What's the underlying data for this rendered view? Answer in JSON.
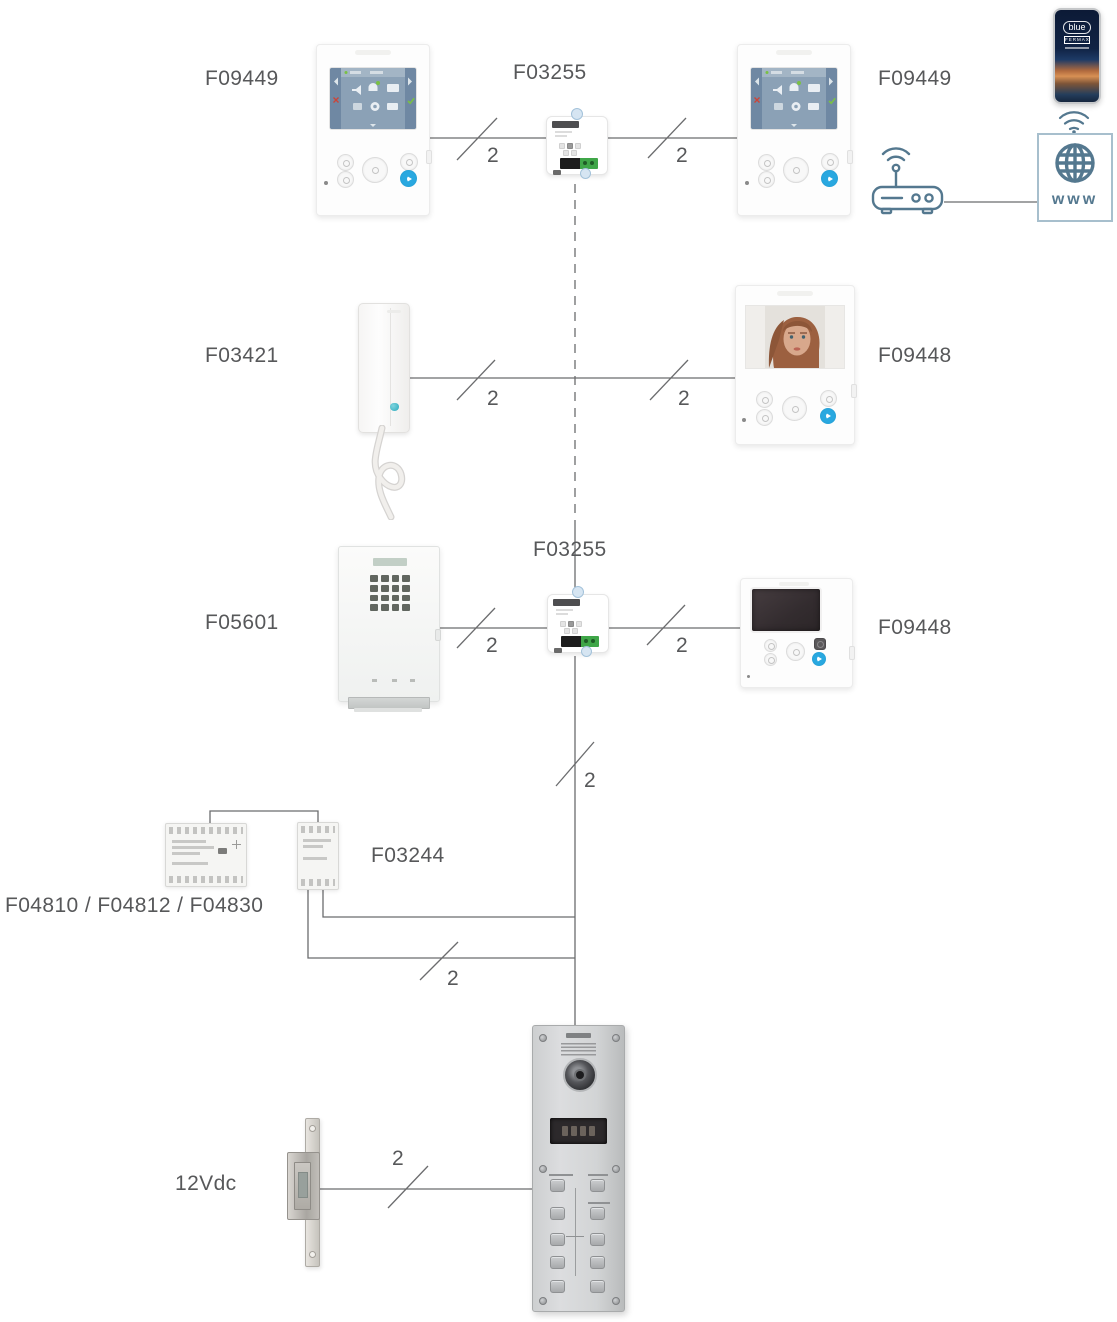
{
  "diagram": {
    "device_labels": {
      "monitor_top_left": "F09449",
      "distributor_top": "F03255",
      "monitor_top_right": "F09449",
      "audio_handset": "F03421",
      "monitor_middle_right": "F09448",
      "digital_panel": "F05601",
      "distributor_middle": "F03255",
      "monitor_bottom_right": "F09448",
      "filter": "F03244",
      "power_supplies": "F04810 / F04812 / F04830",
      "door_lock_voltage": "12Vdc"
    },
    "wire_section_labels": [
      "2",
      "2",
      "2",
      "2",
      "2",
      "2",
      "2",
      "2",
      "2"
    ],
    "internet": {
      "www": "www"
    },
    "smartphone_app": {
      "logo": "blue",
      "brand": "FERMAX"
    },
    "colors": {
      "label_text": "#57585a",
      "wire": "#6b6c6e",
      "accent_blue": "#29a8e0",
      "network_icon": "#54788f",
      "terminal_green": "#3fa648"
    }
  }
}
